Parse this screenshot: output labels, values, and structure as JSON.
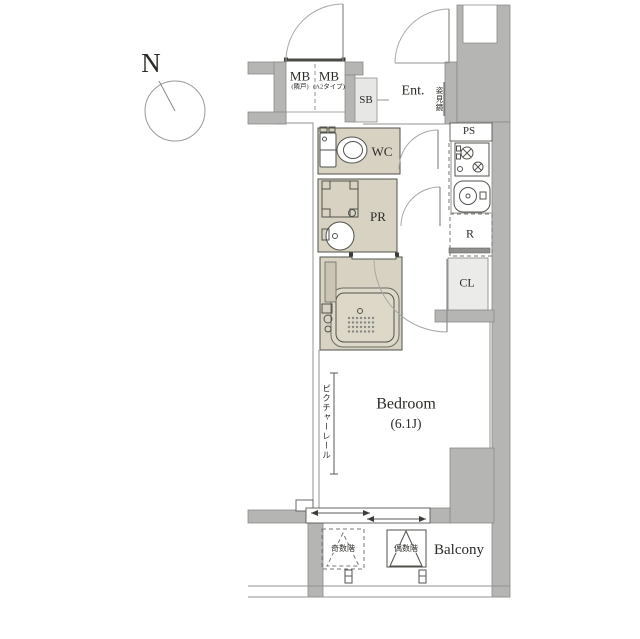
{
  "compass": {
    "label": "N"
  },
  "rooms": {
    "mb_left": {
      "label": "MB",
      "note": "(隣戸)"
    },
    "mb_right": {
      "label": "MB",
      "note": "(A2タイプ)"
    },
    "sb": {
      "label": "SB"
    },
    "entrance": {
      "label": "Ent."
    },
    "mirror": {
      "label": "姿見鏡"
    },
    "ps": {
      "label": "PS"
    },
    "wc": {
      "label": "WC"
    },
    "pr": {
      "label": "PR"
    },
    "refrigerator": {
      "label": "R"
    },
    "closet": {
      "label": "CL"
    },
    "bedroom": {
      "label": "Bedroom",
      "size": "(6.1J)"
    },
    "picture_rail": {
      "label": "ピクチャーレール"
    },
    "hatch_odd": {
      "label": "奇数階"
    },
    "hatch_even": {
      "label": "偶数階"
    },
    "balcony": {
      "label": "Balcony"
    }
  },
  "colors": {
    "wall": "#b5b6b4",
    "wall-stroke": "#8a8a88",
    "room": "#d8d2c2",
    "room-stroke": "#52524d",
    "tub": "#ddd8c8",
    "cl-fill": "#ebebe9",
    "sb-fill": "#e7e7e5",
    "line": "#93938f",
    "line-dark": "#5a5a55",
    "text": "#2b2b28"
  }
}
